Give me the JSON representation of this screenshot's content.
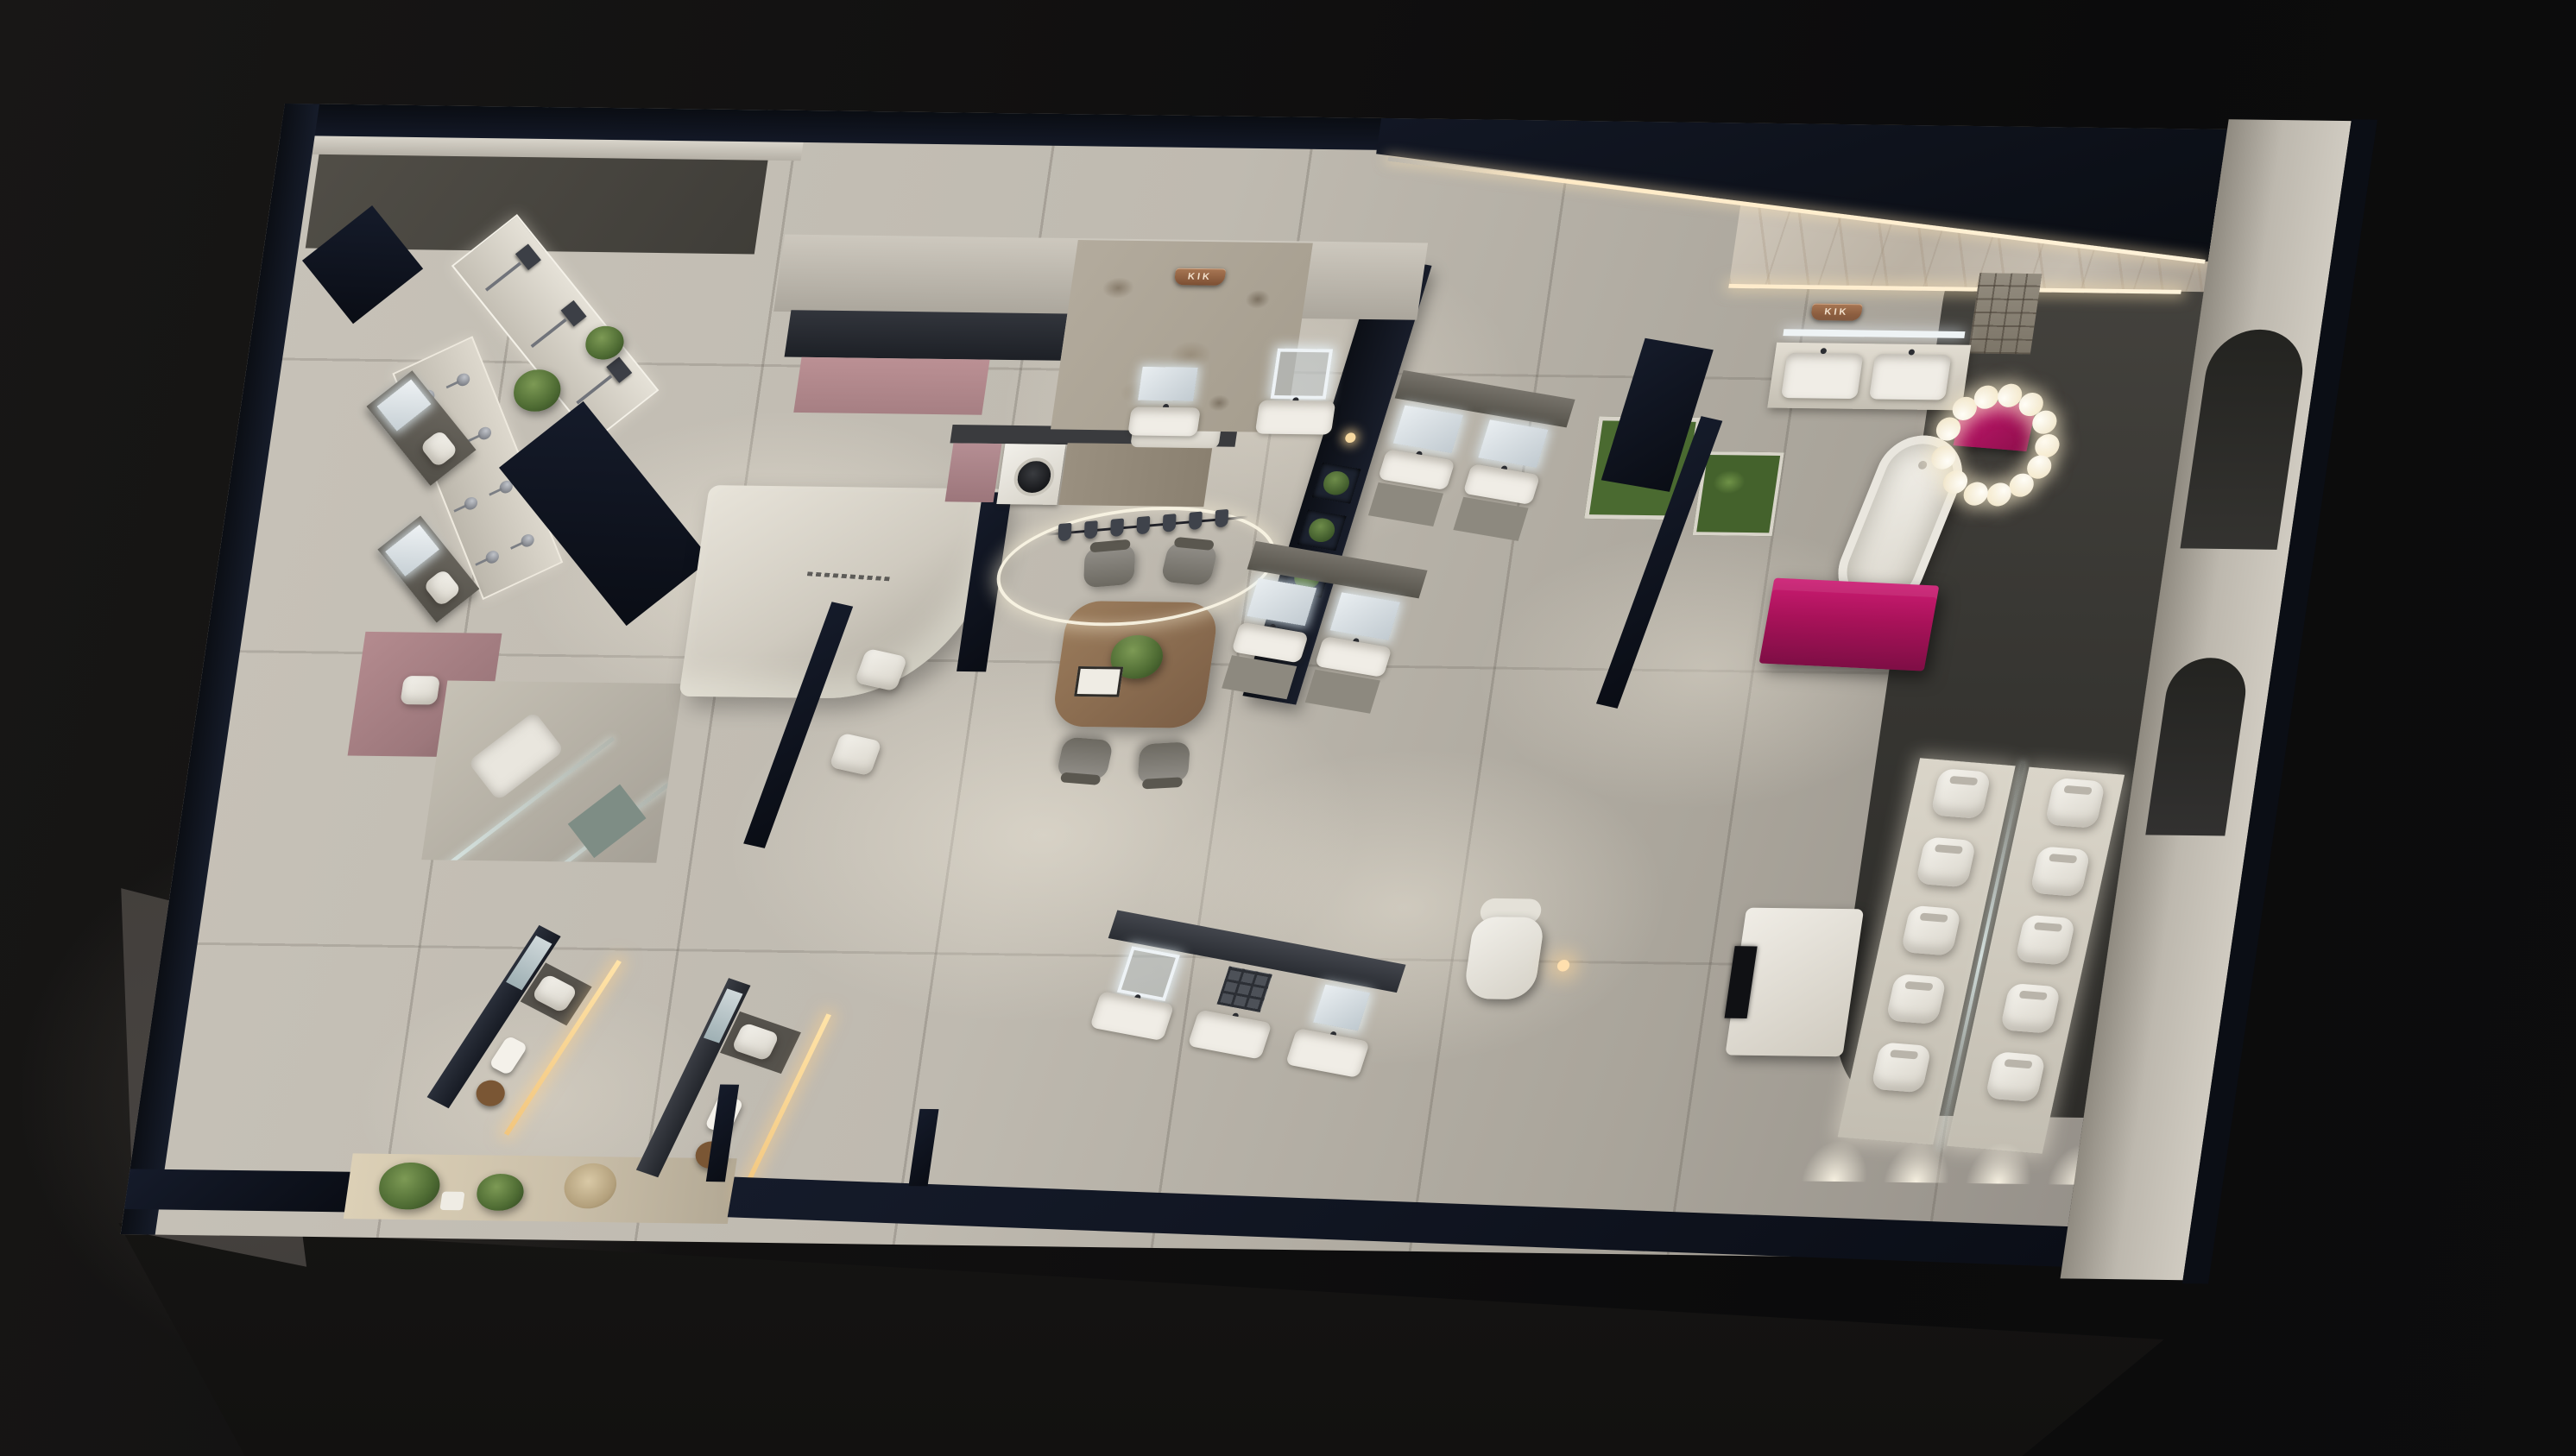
{
  "scene": {
    "type": "3d-showroom-floorplan-render",
    "description": "Night-time top-down cutaway 3D render of a KIK sanitary-ware showroom with cut walls, lit displays and tiled floor",
    "brand": "KIK"
  },
  "signs": {
    "stone_wall_logo": "KIK",
    "suite_wall_logo": "KIK"
  },
  "palette": {
    "background": "#0d0d0e",
    "wall_top": "#10141d",
    "wall_face": "#b5b0a7",
    "floor": "#c0bbb1",
    "floor_dark": "#3c3a36",
    "accent_pink": "#b98e92",
    "accent_magenta": "#b0145f",
    "copper_sign": "#95684a",
    "led_warm": "#ffe9c4",
    "led_cool": "#eef3f6",
    "plant_green": "#53703a",
    "wood": "#8a6e50"
  },
  "counts": {
    "shower_columns": 3,
    "faucet_hooks": 8,
    "rack_cups": 7,
    "dining_chairs": 4,
    "toilets": 10,
    "toilet_columns": 2,
    "spine_shelf_plants": 3,
    "chandelier_bubble_angles": [
      0,
      25,
      52,
      78,
      104,
      132,
      165,
      198,
      226,
      252,
      278,
      305,
      332
    ],
    "floor_light_pool_offsets": [
      0,
      95,
      190,
      285
    ]
  },
  "zones": [
    {
      "id": "shower-display-wall",
      "label": "Shower panel display wall"
    },
    {
      "id": "faucet-display-wall",
      "label": "Faucet and mixer display wall"
    },
    {
      "id": "mirror-vanity-mockups",
      "label": "Mirror vanity mock-up bays"
    },
    {
      "id": "pink-room",
      "label": "Pink accent fitting room"
    },
    {
      "id": "glass-shower-room",
      "label": "Glass shower enclosure mock-up"
    },
    {
      "id": "entrance-garden",
      "label": "Entrance planting bed"
    },
    {
      "id": "reception",
      "label": "Curved reception desk"
    },
    {
      "id": "consultation-dining",
      "label": "Consultation table with ring pendant and cup rack"
    },
    {
      "id": "laundry-corner",
      "label": "Laundry corner with washing machine"
    },
    {
      "id": "stone-logo-wall",
      "label": "Terrazzo logo wall"
    },
    {
      "id": "vanity-gallery",
      "label": "Vanity and LED mirror gallery"
    },
    {
      "id": "indoor-garden",
      "label": "Indoor fern planters"
    },
    {
      "id": "master-suite",
      "label": "Marble suite with freestanding bathtub, magenta cabinet and bubble chandelier"
    },
    {
      "id": "toilet-gallery",
      "label": "Toilet display platforms behind glass"
    },
    {
      "id": "media-lounge",
      "label": "Media console and lounge chair"
    },
    {
      "id": "bath-mockup",
      "label": "Compact bathroom mock-up with towel stool"
    }
  ]
}
